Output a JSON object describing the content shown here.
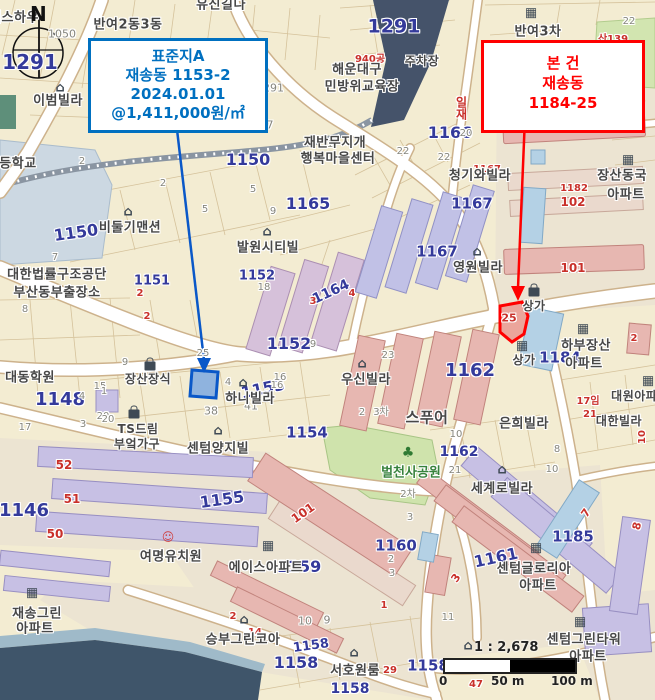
{
  "callouts": {
    "standard": {
      "color": "#0070C0",
      "lines": [
        "표준지A",
        "재송동  1153-2",
        "2024.01.01",
        "@1,411,000원/㎡"
      ]
    },
    "subject": {
      "color": "#FF0000",
      "lines": [
        "본 건",
        "재송동",
        "1184-25"
      ]
    }
  },
  "compass": {
    "label": "N"
  },
  "scale_bar": {
    "ratio": "1 : 2,678",
    "ticks": [
      "0",
      "50 m",
      "100 m"
    ]
  },
  "map": {
    "colors": {
      "standard_parcel": "#0a58c8",
      "subject_parcel": "#FF0000",
      "parcel_number_blue": "#343a9b",
      "minor_number_red": "#c9302a",
      "park_green": "#cfe3ac",
      "water": "#45536a",
      "building_pink": "#e7b7b1",
      "building_purple": "#c7c0e4",
      "building_blue": "#b4d1e5"
    },
    "label_fields": [
      "text",
      "x",
      "y",
      "class",
      "size",
      "rotate"
    ],
    "labels": [
      [
        "1291",
        30,
        62,
        "blue",
        20,
        0
      ],
      [
        "1291",
        394,
        27,
        "blue",
        19,
        0
      ],
      [
        "1166",
        450,
        133,
        "blue",
        16,
        0
      ],
      [
        "1167",
        472,
        204,
        "blue",
        15,
        0
      ],
      [
        "1167",
        437,
        252,
        "blue",
        15,
        0
      ],
      [
        "1150",
        76,
        233,
        "blue",
        16,
        -8
      ],
      [
        "1150",
        248,
        160,
        "blue",
        16,
        0
      ],
      [
        "1165",
        308,
        204,
        "blue",
        16,
        0
      ],
      [
        "1164",
        331,
        292,
        "blue",
        14,
        -25
      ],
      [
        "1153",
        263,
        389,
        "blue",
        16,
        -12
      ],
      [
        "1151",
        152,
        281,
        "blue",
        13,
        0
      ],
      [
        "1152",
        257,
        276,
        "blue",
        13,
        0
      ],
      [
        "1152",
        289,
        344,
        "blue",
        16,
        0
      ],
      [
        "1148",
        60,
        400,
        "blue",
        18,
        0
      ],
      [
        "1146",
        24,
        511,
        "blue",
        18,
        0
      ],
      [
        "1155",
        222,
        500,
        "blue",
        16,
        -8
      ],
      [
        "1154",
        307,
        433,
        "blue",
        15,
        0
      ],
      [
        "1162",
        470,
        371,
        "blue",
        18,
        0
      ],
      [
        "1162",
        459,
        452,
        "blue",
        14,
        0
      ],
      [
        "1184",
        560,
        358,
        "blue",
        15,
        0
      ],
      [
        "1160",
        396,
        546,
        "blue",
        15,
        0
      ],
      [
        "1161",
        496,
        558,
        "blue",
        16,
        -12
      ],
      [
        "1185",
        573,
        537,
        "blue",
        15,
        0
      ],
      [
        "1159",
        299,
        567,
        "blue",
        16,
        0
      ],
      [
        "1158",
        311,
        646,
        "blue",
        13,
        -8
      ],
      [
        "1158",
        296,
        663,
        "blue",
        16,
        0
      ],
      [
        "1158",
        350,
        689,
        "blue",
        14,
        0
      ],
      [
        "1158",
        428,
        666,
        "blue",
        15,
        0
      ],
      [
        "1050",
        62,
        34,
        "gray",
        11,
        0
      ],
      [
        "977",
        263,
        125,
        "gray",
        11,
        0
      ],
      [
        "1291",
        270,
        88,
        "gray",
        11,
        0
      ],
      [
        "7",
        55,
        258,
        "gray",
        10,
        0
      ],
      [
        "8",
        25,
        310,
        "gray",
        10,
        0
      ],
      [
        "2",
        82,
        162,
        "gray",
        10,
        0
      ],
      [
        "2",
        163,
        184,
        "gray",
        10,
        0
      ],
      [
        "5",
        253,
        190,
        "gray",
        10,
        0
      ],
      [
        "5",
        205,
        210,
        "gray",
        10,
        0
      ],
      [
        "9",
        273,
        212,
        "gray",
        10,
        0
      ],
      [
        "1",
        330,
        145,
        "gray",
        10,
        0
      ],
      [
        "20",
        466,
        134,
        "gray",
        10,
        0
      ],
      [
        "22",
        403,
        152,
        "gray",
        10,
        0
      ],
      [
        "22",
        444,
        158,
        "gray",
        10,
        0
      ],
      [
        "22",
        629,
        22,
        "gray",
        10,
        0
      ],
      [
        "18",
        264,
        288,
        "gray",
        10,
        0
      ],
      [
        "9",
        313,
        345,
        "gray",
        10,
        0
      ],
      [
        "15",
        100,
        387,
        "gray",
        10,
        0
      ],
      [
        "4",
        82,
        397,
        "gray",
        10,
        0
      ],
      [
        "1",
        104,
        392,
        "gray",
        10,
        0
      ],
      [
        "9",
        125,
        363,
        "gray",
        10,
        0
      ],
      [
        "38",
        211,
        411,
        "gray",
        11,
        0
      ],
      [
        "41",
        251,
        406,
        "gray",
        11,
        0
      ],
      [
        "20",
        103,
        417,
        "gray",
        10,
        0
      ],
      [
        "4",
        228,
        383,
        "gray",
        10,
        0
      ],
      [
        "16",
        277,
        386,
        "gray",
        10,
        0
      ],
      [
        "25",
        203,
        354,
        "gray",
        10,
        0
      ],
      [
        "23",
        388,
        356,
        "gray",
        10,
        0
      ],
      [
        "16",
        280,
        378,
        "gray",
        10,
        0
      ],
      [
        "2",
        362,
        413,
        "gray",
        10,
        0
      ],
      [
        "3차",
        381,
        413,
        "gray",
        10,
        0
      ],
      [
        "2차",
        408,
        495,
        "gray",
        10,
        0
      ],
      [
        "3",
        410,
        518,
        "gray",
        10,
        0
      ],
      [
        "10",
        456,
        435,
        "gray",
        10,
        0
      ],
      [
        "21",
        455,
        471,
        "gray",
        10,
        0
      ],
      [
        "8",
        557,
        450,
        "gray",
        10,
        0
      ],
      [
        "10",
        552,
        470,
        "gray",
        10,
        0
      ],
      [
        "2",
        391,
        560,
        "gray",
        10,
        0
      ],
      [
        "3",
        392,
        574,
        "gray",
        10,
        0
      ],
      [
        "10",
        305,
        621,
        "gray",
        11,
        0
      ],
      [
        "9",
        327,
        620,
        "gray",
        11,
        0
      ],
      [
        "17",
        25,
        428,
        "gray",
        10,
        0
      ],
      [
        "3",
        83,
        425,
        "gray",
        10,
        0
      ],
      [
        "20",
        108,
        420,
        "gray",
        10,
        0
      ],
      [
        "11",
        448,
        618,
        "gray",
        10,
        0
      ],
      [
        "940공",
        370,
        60,
        "red",
        10,
        0
      ],
      [
        "산139",
        613,
        40,
        "red",
        10,
        0
      ],
      [
        "8임",
        618,
        54,
        "olive",
        10,
        0
      ],
      [
        "1167",
        487,
        170,
        "red",
        10,
        0
      ],
      [
        "1182",
        574,
        189,
        "red",
        10,
        0
      ],
      [
        "102",
        573,
        202,
        "red",
        12,
        0
      ],
      [
        "101",
        573,
        268,
        "red",
        12,
        0
      ],
      [
        "101",
        303,
        513,
        "red",
        12,
        -35
      ],
      [
        "52",
        64,
        465,
        "red",
        12,
        0
      ],
      [
        "51",
        72,
        499,
        "red",
        12,
        0
      ],
      [
        "50",
        55,
        534,
        "red",
        12,
        0
      ],
      [
        "3",
        313,
        302,
        "red",
        10,
        0
      ],
      [
        "4",
        352,
        294,
        "red",
        10,
        0
      ],
      [
        "25",
        509,
        318,
        "red",
        11,
        0
      ],
      [
        "17임",
        588,
        402,
        "red",
        10,
        0
      ],
      [
        "21",
        590,
        415,
        "red",
        10,
        0
      ],
      [
        "2",
        634,
        339,
        "red",
        10,
        0
      ],
      [
        "7",
        586,
        513,
        "red",
        11,
        -55
      ],
      [
        "8",
        637,
        526,
        "red",
        11,
        -75
      ],
      [
        "3",
        456,
        578,
        "red",
        11,
        -55
      ],
      [
        "47",
        476,
        685,
        "red",
        10,
        0
      ],
      [
        "29",
        390,
        671,
        "red",
        10,
        0
      ],
      [
        "2",
        233,
        617,
        "red",
        10,
        0
      ],
      [
        "10",
        643,
        437,
        "red",
        10,
        -90
      ],
      [
        "1",
        384,
        606,
        "red",
        10,
        0
      ],
      [
        "2",
        140,
        294,
        "red",
        10,
        0
      ],
      [
        "2",
        147,
        317,
        "red",
        10,
        0
      ],
      [
        "14",
        255,
        633,
        "red",
        10,
        0
      ],
      [
        "일재",
        461,
        108,
        "vred",
        12,
        0
      ],
      [
        "게스하우",
        14,
        18,
        "name",
        13,
        0
      ],
      [
        "반여2동3동",
        128,
        25,
        "name",
        13,
        0
      ],
      [
        "유신길다",
        221,
        5,
        "name",
        13,
        0
      ],
      [
        "이범빌라",
        58,
        101,
        "name",
        13,
        0
      ],
      [
        "등학교",
        18,
        164,
        "name",
        13,
        0
      ],
      [
        "주차장",
        422,
        61,
        "name",
        12,
        0
      ],
      [
        "해운대구",
        357,
        70,
        "name",
        13,
        0
      ],
      [
        "민방위교육장",
        362,
        87,
        "name",
        13,
        0
      ],
      [
        "반여3차",
        538,
        32,
        "name",
        13,
        0
      ],
      [
        "재반무지개",
        335,
        143,
        "name",
        13,
        0
      ],
      [
        "행복마을센터",
        338,
        159,
        "name",
        13,
        0
      ],
      [
        "비둘기맨션",
        130,
        228,
        "name",
        13,
        0
      ],
      [
        "청기와빌라",
        480,
        176,
        "name",
        13,
        0
      ],
      [
        "장산동국",
        622,
        176,
        "name",
        13,
        0
      ],
      [
        "아파트",
        626,
        195,
        "name",
        13,
        0
      ],
      [
        "영원빌라",
        478,
        268,
        "name",
        13,
        0
      ],
      [
        "대한법률구조공단",
        57,
        275,
        "name",
        13,
        0
      ],
      [
        "부산동부출장소",
        57,
        293,
        "name",
        13,
        0
      ],
      [
        "대동학원",
        30,
        378,
        "name",
        13,
        0
      ],
      [
        "장산장식",
        148,
        379,
        "name",
        12,
        0
      ],
      [
        "하니빌라",
        250,
        399,
        "name",
        13,
        0
      ],
      [
        "발원시티빌",
        268,
        248,
        "name",
        13,
        0
      ],
      [
        "우신빌라",
        366,
        380,
        "name",
        13,
        0
      ],
      [
        "TS드림",
        138,
        429,
        "name",
        12,
        0
      ],
      [
        "부엌가구",
        137,
        444,
        "name",
        12,
        0
      ],
      [
        "센텀양지빌",
        218,
        449,
        "name",
        13,
        0
      ],
      [
        "스푸어",
        427,
        418,
        "name",
        15,
        0
      ],
      [
        "은희빌라",
        524,
        424,
        "name",
        13,
        0
      ],
      [
        "세계로빌라",
        502,
        489,
        "name",
        13,
        0
      ],
      [
        "하부장산",
        586,
        346,
        "name",
        13,
        0
      ],
      [
        "아파트",
        584,
        364,
        "name",
        13,
        0
      ],
      [
        "상가",
        534,
        306,
        "name",
        12,
        0
      ],
      [
        "상가",
        524,
        360,
        "name",
        12,
        0
      ],
      [
        "대원아파트",
        640,
        396,
        "name",
        12,
        0
      ],
      [
        "대한빌라",
        619,
        421,
        "name",
        12,
        0
      ],
      [
        "센텀글로리아",
        534,
        569,
        "name",
        13,
        0
      ],
      [
        "아파트",
        538,
        586,
        "name",
        13,
        0
      ],
      [
        "여명유치원",
        171,
        557,
        "name",
        13,
        0
      ],
      [
        "에이스아파트",
        266,
        568,
        "name",
        13,
        0
      ],
      [
        "재송그린",
        37,
        614,
        "name",
        13,
        0
      ],
      [
        "아파트",
        35,
        629,
        "name",
        13,
        0
      ],
      [
        "승부그린코아",
        243,
        640,
        "name",
        13,
        0
      ],
      [
        "서호원룸",
        355,
        671,
        "name",
        13,
        0
      ],
      [
        "센텀그린타워",
        584,
        640,
        "name",
        13,
        0
      ],
      [
        "아파트",
        588,
        657,
        "name",
        13,
        0
      ],
      [
        "벌천사공원",
        411,
        473,
        "gname",
        13,
        0
      ]
    ],
    "icon_fields": [
      "type",
      "x",
      "y"
    ],
    "icons": [
      [
        "house-icon",
        60,
        88
      ],
      [
        "house-icon",
        128,
        212
      ],
      [
        "house-icon",
        267,
        232
      ],
      [
        "house-icon",
        477,
        252
      ],
      [
        "house-icon",
        243,
        383
      ],
      [
        "house-icon",
        362,
        364
      ],
      [
        "house-icon",
        218,
        431
      ],
      [
        "house-icon",
        502,
        470
      ],
      [
        "house-icon",
        244,
        620
      ],
      [
        "house-icon",
        354,
        653
      ],
      [
        "house-icon",
        468,
        646
      ],
      [
        "bag-icon",
        150,
        366
      ],
      [
        "bag-icon",
        134,
        414
      ],
      [
        "bag-icon",
        534,
        292
      ],
      [
        "building-icon",
        531,
        13
      ],
      [
        "building-icon",
        628,
        160
      ],
      [
        "building-icon",
        583,
        329
      ],
      [
        "building-icon",
        522,
        346
      ],
      [
        "building-icon",
        536,
        548
      ],
      [
        "building-icon",
        268,
        546
      ],
      [
        "building-icon",
        32,
        593
      ],
      [
        "building-icon",
        580,
        622
      ],
      [
        "building-icon",
        648,
        381
      ],
      [
        "tree-icon",
        408,
        453
      ],
      [
        "child-icon",
        168,
        537
      ]
    ]
  }
}
